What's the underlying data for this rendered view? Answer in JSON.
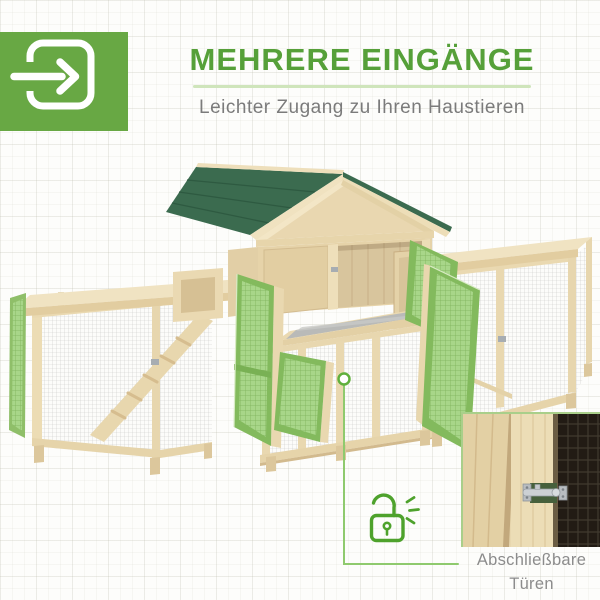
{
  "badge": {
    "icon": "login-arrow-icon",
    "background": "#68A844"
  },
  "header": {
    "title": "MEHRERE EINGÄNGE",
    "subtitle": "Leichter Zugang zu Ihren Haustieren"
  },
  "callout": {
    "icon": "unlocked-padlock-icon",
    "label_line1": "Abschließbare",
    "label_line2": "Türen"
  },
  "illustration": {
    "subject": "wooden pet hutch with dark-green shingle roof, two wire-mesh runs, ramp, pull-out tray and open green mesh doors",
    "inset_subject": "close-up of lockable wooden door with metal slide latch"
  },
  "colors": {
    "accent_green": "#56A039",
    "badge_green": "#68A844",
    "callout_green": "#4EA22C",
    "line_green": "#8FCA6E",
    "underline_green": "#CFE5BB",
    "roof_green": "#3B6B4F",
    "door_green": "#8CBE66",
    "wood_light": "#EDDDB6",
    "text_gray": "#7B7B7B",
    "caption_gray": "#8C8C8C"
  }
}
